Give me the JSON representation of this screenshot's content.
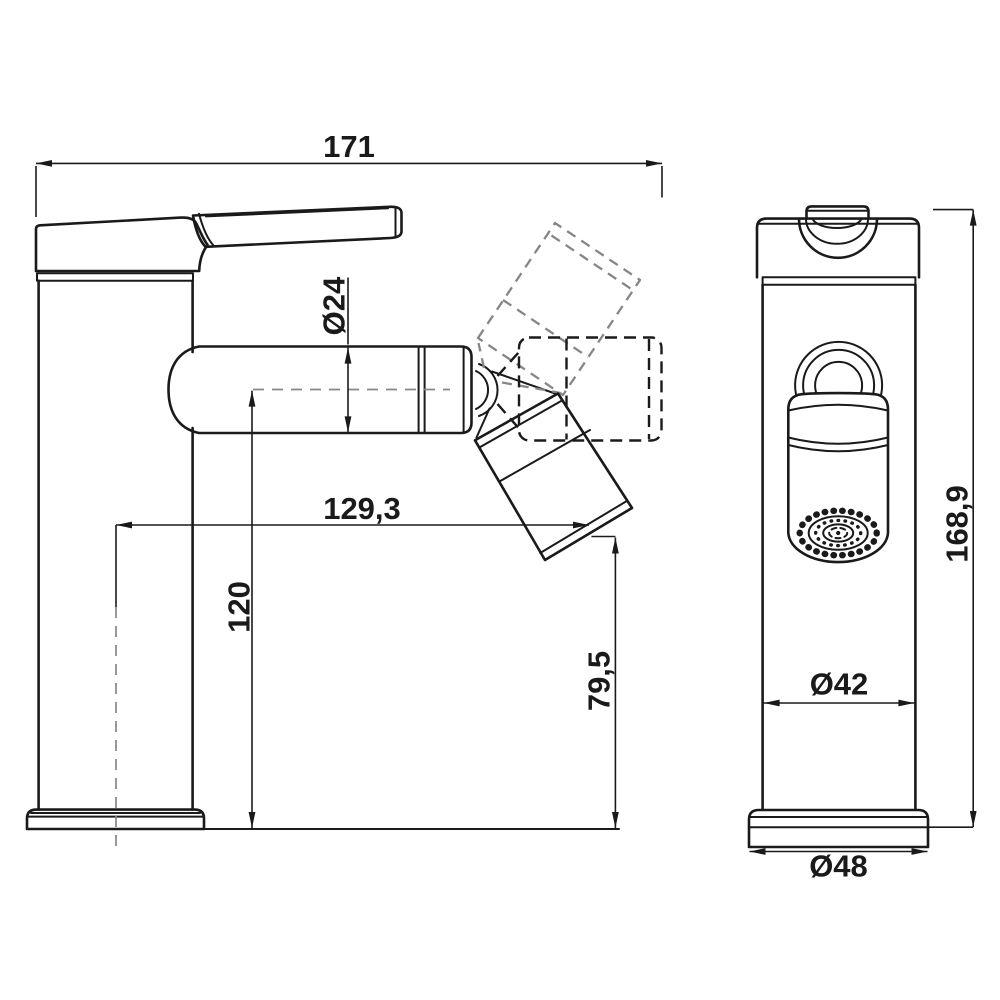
{
  "labels": {
    "overall_length": "171",
    "spout_diameter": "Ø24",
    "spout_reach": "129,3",
    "spout_center_height": "120",
    "outlet_height": "79,5",
    "overall_height": "168,9",
    "body_diameter": "Ø42",
    "base_diameter": "Ø48"
  },
  "colors": {
    "ink": "#1a1a1a",
    "muted": "#868686",
    "bg": "#ffffff"
  }
}
